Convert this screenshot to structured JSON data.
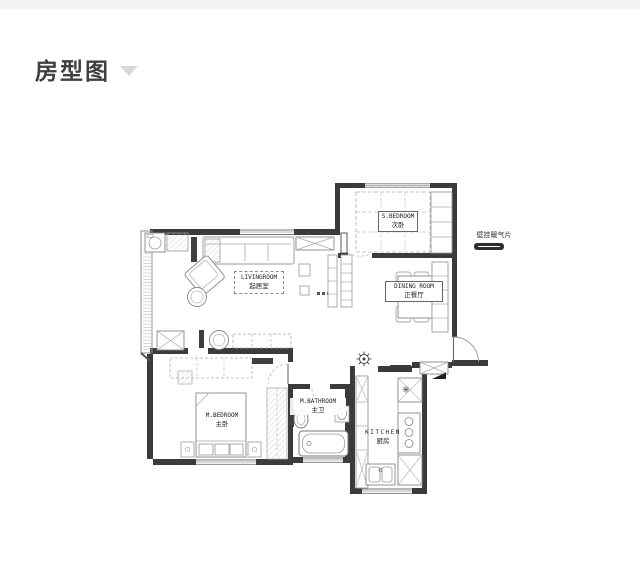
{
  "page": {
    "background": "#ffffff",
    "topbar_color": "#f4f4f4"
  },
  "header": {
    "title": "房型图",
    "title_color": "#3f3f3f",
    "chevron_icon": "chevron-down",
    "chevron_color": "#d8d8d8"
  },
  "floorplan": {
    "rooms": [
      {
        "id": "s-bedroom",
        "en": "S.BEDROOM",
        "zh": "次卧"
      },
      {
        "id": "livingroom",
        "en": "LIVINGROOM",
        "zh": "起居室"
      },
      {
        "id": "dining",
        "en": "DINING ROOM",
        "zh": "正餐厅"
      },
      {
        "id": "m-bedroom",
        "en": "M.BEDROOM",
        "zh": "主卧"
      },
      {
        "id": "m-bathroom",
        "en": "M.BATHROOM",
        "zh": "主卫"
      },
      {
        "id": "kitchen",
        "en": "KITCHEN",
        "zh": "厨房"
      }
    ],
    "annotation": {
      "text": "壁挂暖气片",
      "symbol": "radiator-pill"
    },
    "colors": {
      "wall": "#3b3b3b",
      "furniture_line": "#999999",
      "light_line": "#b5b5b5",
      "dark_fixture": "#3f3f3f",
      "hatch": "#c9c9c9"
    }
  }
}
